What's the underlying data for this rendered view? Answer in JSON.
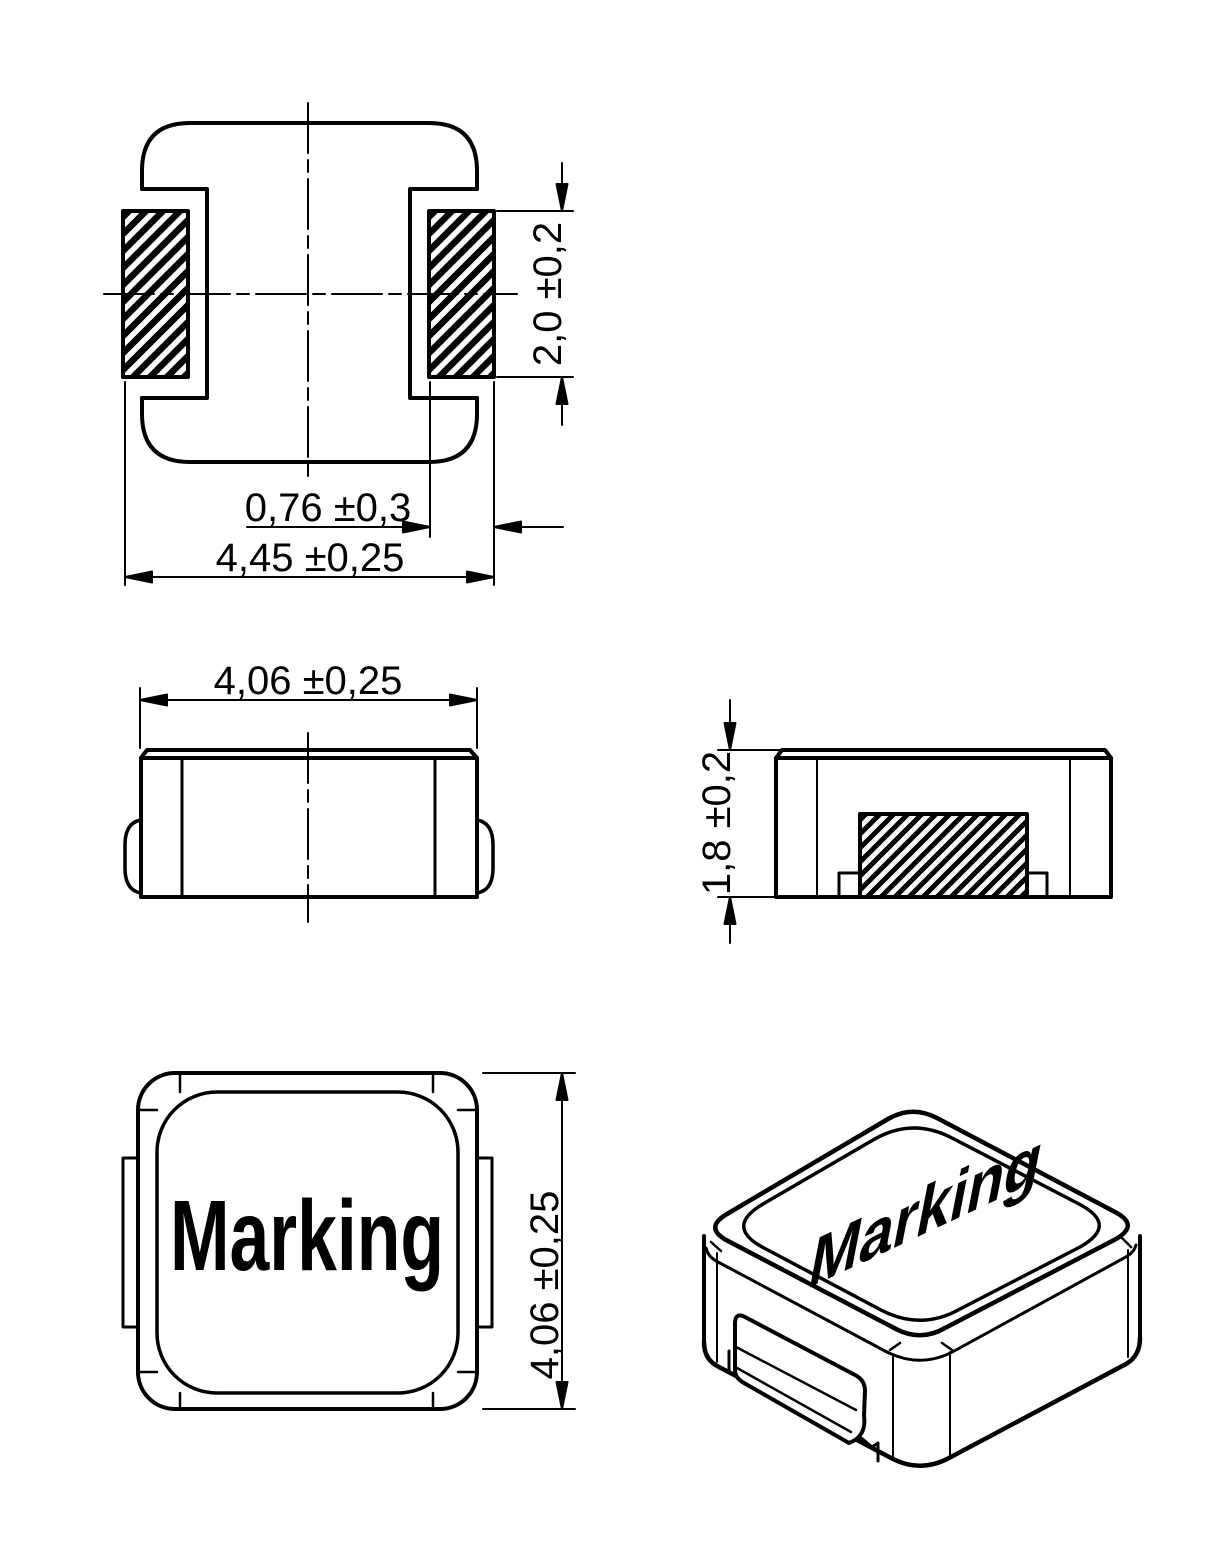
{
  "page": {
    "background": "#ffffff",
    "line_color": "#000000",
    "content_type": "technical-dimension-drawing"
  },
  "views": {
    "top": {
      "dims": {
        "pad_length": "2,0 ±0,2",
        "pad_width": "0,76 ±0,3",
        "overall_width": "4,45 ±0,25"
      }
    },
    "front": {
      "dims": {
        "body_width": "4,06 ±0,25"
      }
    },
    "side": {
      "dims": {
        "body_height": "1,8 ±0,2"
      }
    },
    "bottom": {
      "marking": "Marking",
      "dims": {
        "body_length": "4,06 ±0,25"
      }
    },
    "iso": {
      "marking": "Marking"
    }
  }
}
